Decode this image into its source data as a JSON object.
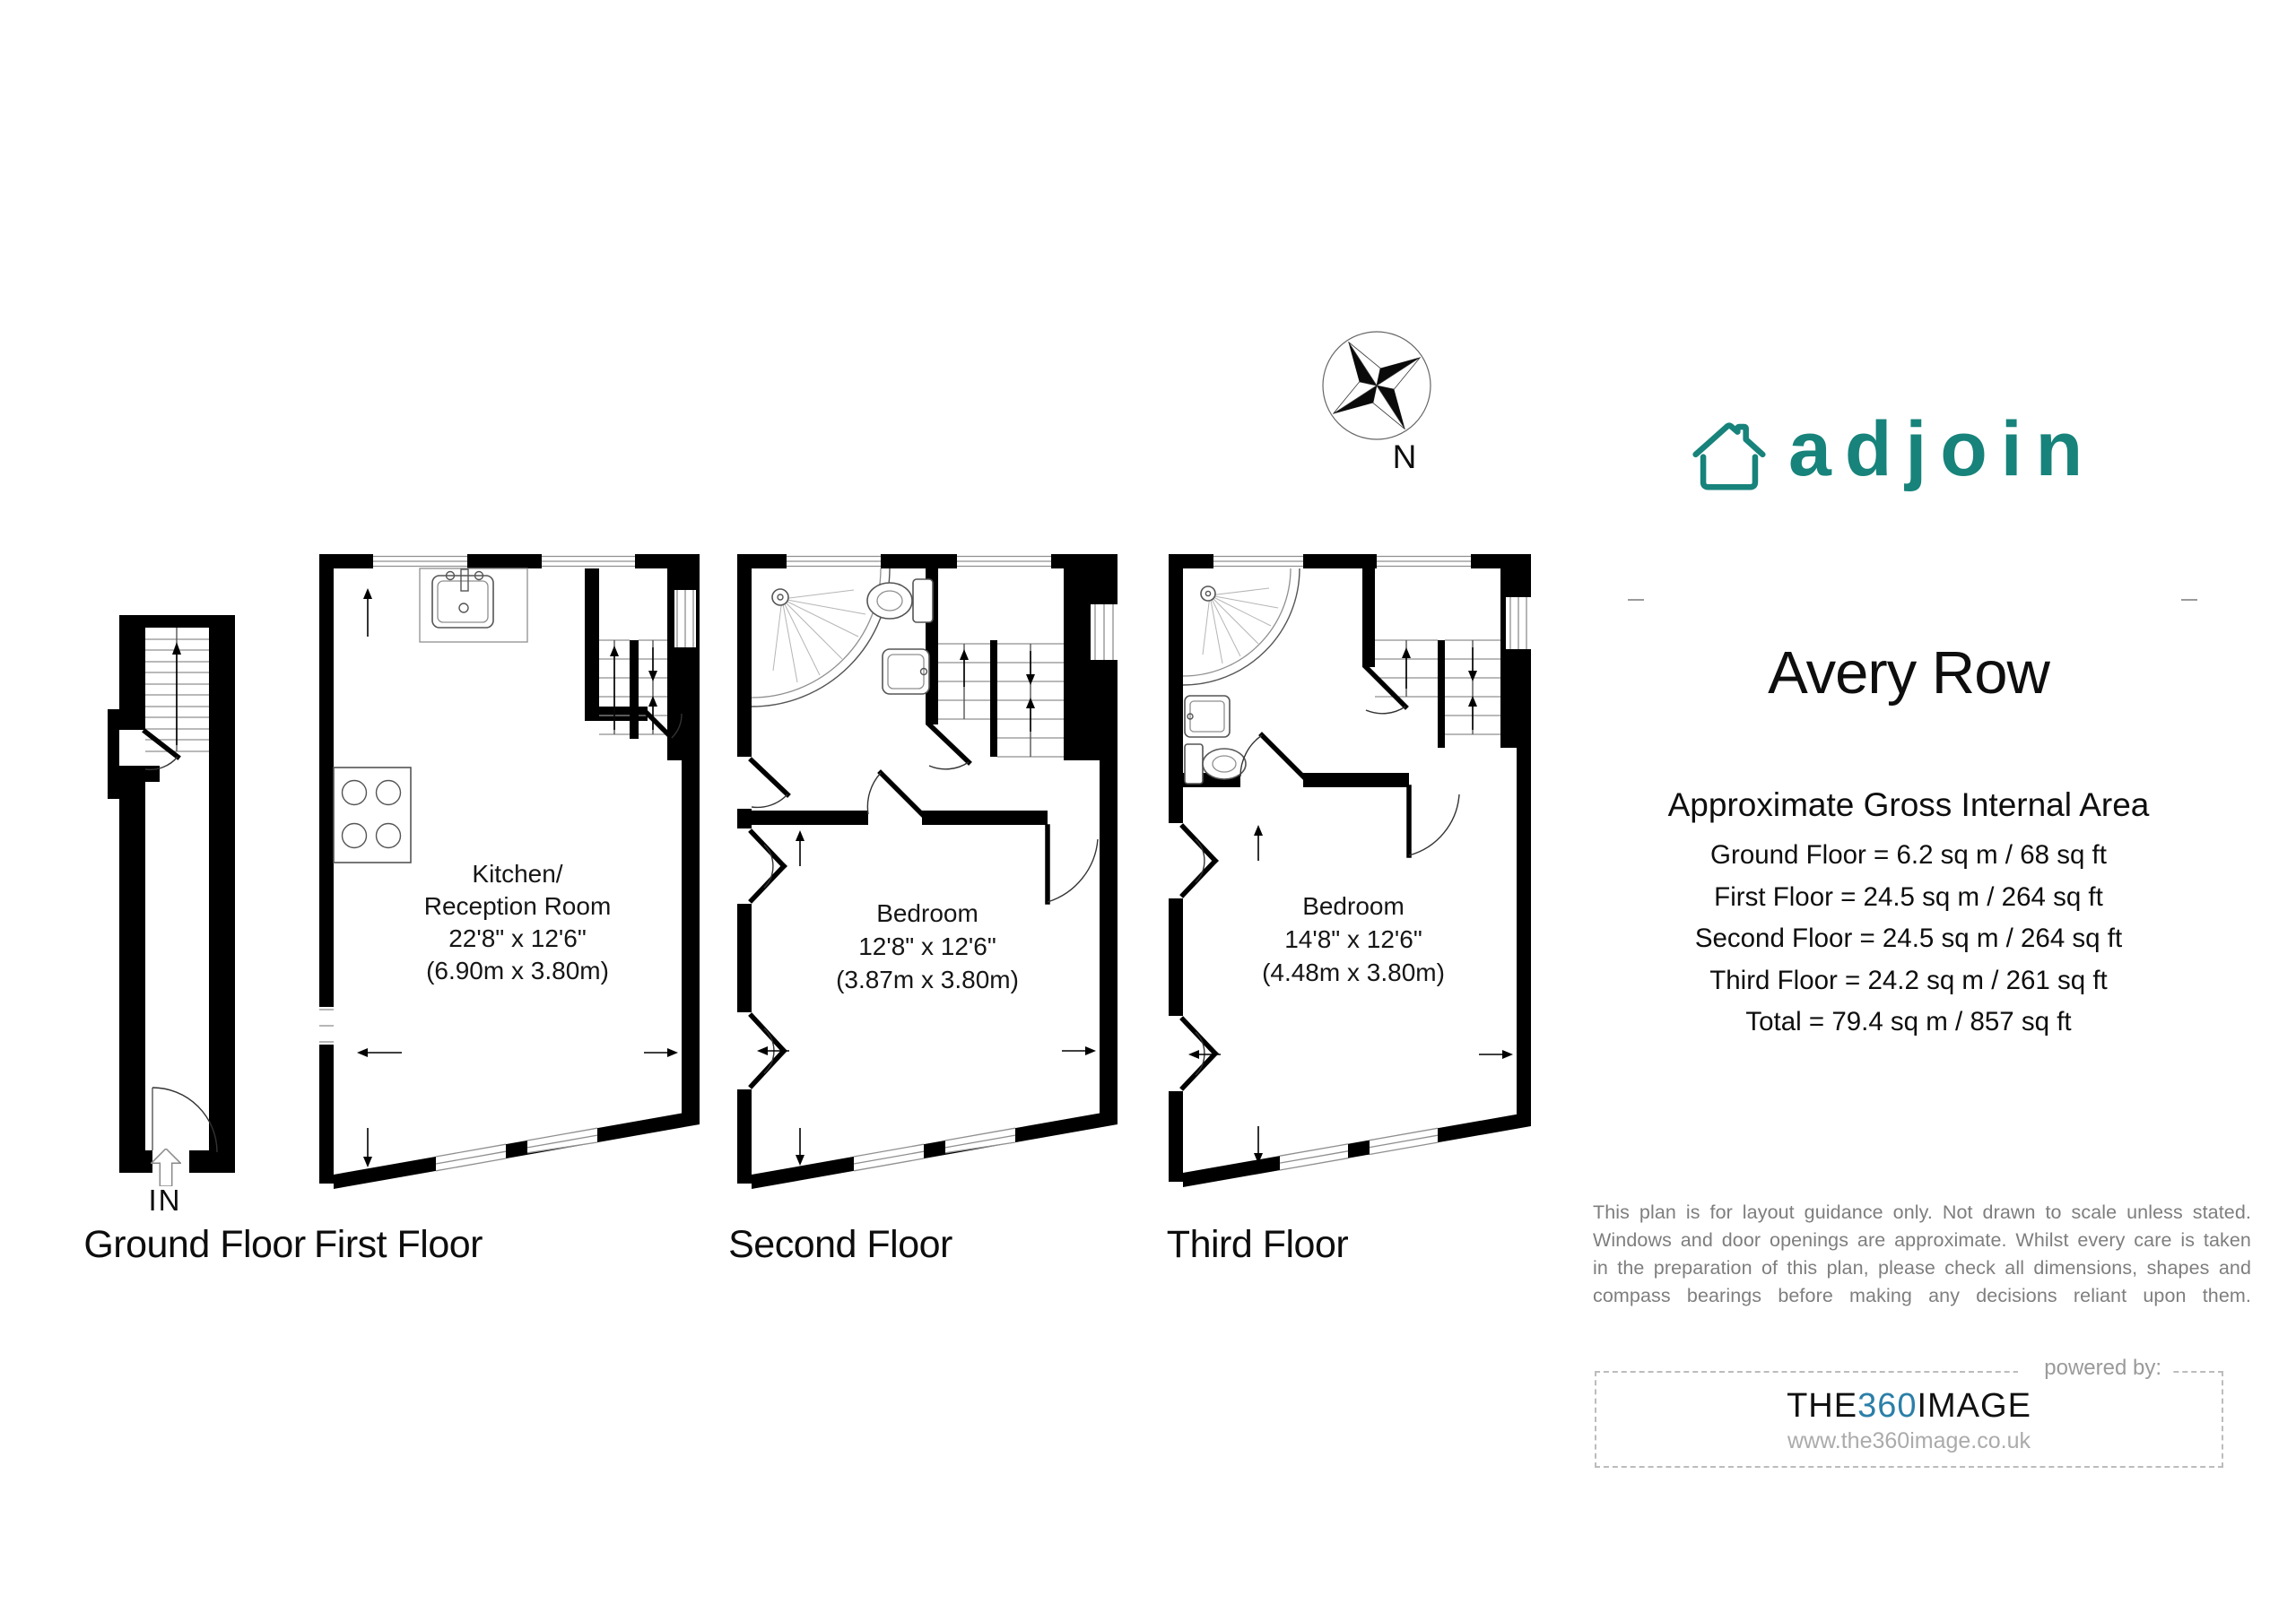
{
  "colors": {
    "brand_teal": "#17837B",
    "brand_blue": "#2B7FA8",
    "text": "#111111",
    "disclaimer_gray": "#7E7E7E",
    "muted_gray": "#9A9A9A",
    "wall_black": "#000000"
  },
  "compass": {
    "label": "N"
  },
  "logo": {
    "wordmark": "adjoin"
  },
  "plans": {
    "ground": {
      "caption": "Ground Floor",
      "entry": "IN"
    },
    "first": {
      "caption": "First Floor",
      "room_line1": "Kitchen/",
      "room_line2": "Reception Room",
      "dims": "22'8\" x 12'6\"",
      "metric": "(6.90m x 3.80m)"
    },
    "second": {
      "caption": "Second Floor",
      "room_line1": "Bedroom",
      "dims": "12'8\" x 12'6\"",
      "metric": "(3.87m x 3.80m)"
    },
    "third": {
      "caption": "Third Floor",
      "room_line1": "Bedroom",
      "dims": "14'8\" x 12'6\"",
      "metric": "(4.48m x 3.80m)"
    }
  },
  "details": {
    "title": "Avery Row",
    "subtitle": "Approximate Gross Internal Area",
    "areas": [
      "Ground Floor = 6.2 sq m / 68 sq ft",
      "First Floor = 24.5 sq m / 264 sq ft",
      "Second Floor = 24.5 sq m / 264 sq ft",
      "Third Floor = 24.2 sq m / 261 sq ft",
      "Total = 79.4 sq m / 857 sq ft"
    ],
    "disclaimer_lines": [
      "This plan is for layout guidance only. Not drawn to scale unless stated.",
      "Windows and door openings are approximate. Whilst every care is taken",
      "in the preparation of this plan, please check all dimensions, shapes and",
      "compass bearings before making any decisions reliant upon them."
    ]
  },
  "footer": {
    "powered_by": "powered by:",
    "brand_prefix": "THE",
    "brand_number": "360",
    "brand_suffix": "IMAGE",
    "website": "www.the360image.co.uk"
  }
}
